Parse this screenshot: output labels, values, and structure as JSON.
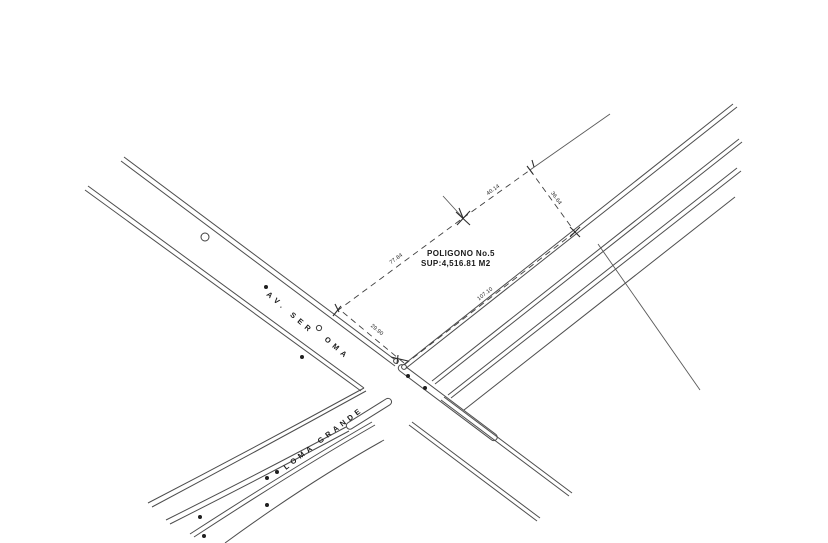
{
  "drawing": {
    "polygon": {
      "title": "POLIGONO No.5",
      "area": "SUP:4,516.81 M2",
      "sides": [
        {
          "edge": "A-B (along AV. SER ROMA)",
          "length": "29.90"
        },
        {
          "edge": "B-C (northwest boundary)",
          "length": "77.84"
        },
        {
          "edge": "C-D (north boundary)",
          "length": "40.14"
        },
        {
          "edge": "D-E (northeast boundary)",
          "length": "36.64"
        },
        {
          "edge": "E-A (along LOMA GRANDE)",
          "length": "107.10"
        }
      ]
    },
    "streets": {
      "avenue": {
        "label_start": "AV. SER",
        "label_end": "OMA"
      },
      "loma_grande": {
        "label": "LOMA GRANDE"
      }
    },
    "colors": {
      "background": "#ffffff",
      "line": "#4d4d4d",
      "text": "#1a1a1a"
    }
  }
}
